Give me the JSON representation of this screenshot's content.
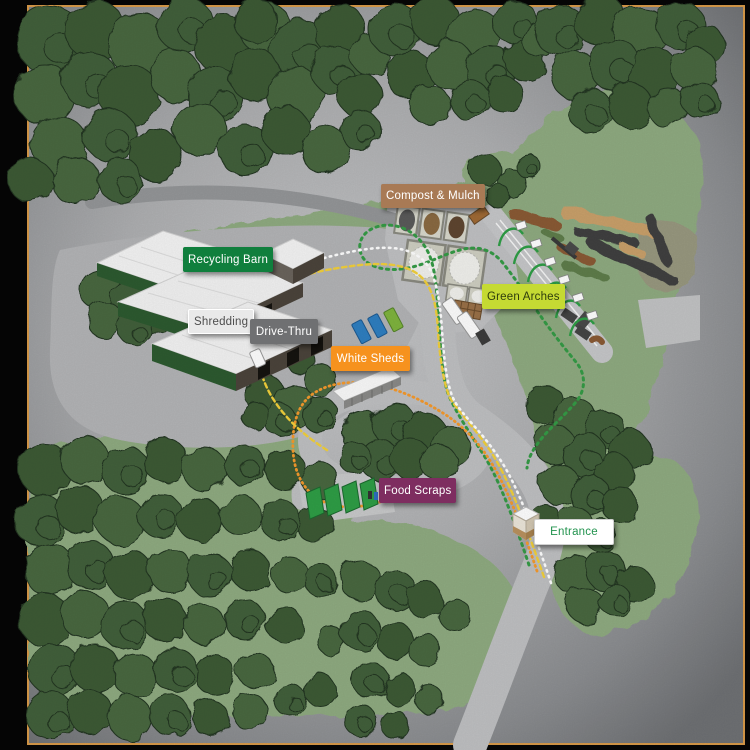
{
  "map": {
    "labels": [
      {
        "id": "compost-mulch",
        "text": "Compost & Mulch",
        "bg": "#a87a55",
        "fg": "#ffffff",
        "x": 381,
        "y": 184,
        "w": 94,
        "h": 24
      },
      {
        "id": "recycling-barn",
        "text": "Recycling Barn",
        "bg": "#107f3d",
        "fg": "#ffffff",
        "x": 183,
        "y": 247,
        "w": 87,
        "h": 25
      },
      {
        "id": "shredding",
        "text": "Shredding",
        "bg": "#e9e9e9",
        "fg": "#4d4d4d",
        "border": "#ffffff",
        "x": 188,
        "y": 309,
        "w": 65,
        "h": 25
      },
      {
        "id": "drive-thru",
        "text": "Drive-Thru",
        "bg": "#6f7072",
        "fg": "#ffffff",
        "x": 250,
        "y": 319,
        "w": 68,
        "h": 25
      },
      {
        "id": "green-arches",
        "text": "Green Arches",
        "bg": "#c5da33",
        "fg": "#2f3d0d",
        "x": 482,
        "y": 284,
        "w": 82,
        "h": 25
      },
      {
        "id": "white-sheds",
        "text": "White Sheds",
        "bg": "#f6921e",
        "fg": "#ffffff",
        "x": 331,
        "y": 346,
        "w": 79,
        "h": 25
      },
      {
        "id": "food-scraps",
        "text": "Food Scraps",
        "bg": "#7e2d60",
        "fg": "#ffffff",
        "x": 379,
        "y": 478,
        "w": 77,
        "h": 25
      },
      {
        "id": "entrance",
        "text": "Entrance",
        "bg": "#ffffff",
        "fg": "#22934e",
        "border": "#d0d0d0",
        "x": 534,
        "y": 519,
        "w": 80,
        "h": 26
      }
    ],
    "routes": {
      "white": "#ffffff",
      "yellow": "#f2d03c",
      "orange": "#f59a2d",
      "green": "#359b46"
    },
    "palette": {
      "background": "#060606",
      "site_border": "#d89a49",
      "pavement": "#bfc0c2",
      "grass": "#8fab81",
      "tree": "#42603a",
      "tree_outline": "#243622",
      "barn_roof": "#f3f3f3",
      "barn_wall": "#4b443b",
      "barn_trim_green": "#2d5a30",
      "compost_brown": "#8a5a35",
      "mulch_tan": "#c9a06b",
      "windrow_dark": "#3f4140",
      "windrow_green": "#5f7d4c",
      "container_blue": "#2f7fc1",
      "container_green": "#7fb43e",
      "bin_green": "#2f9e46",
      "label_shadow": "rgba(0,0,0,0.45)"
    }
  }
}
